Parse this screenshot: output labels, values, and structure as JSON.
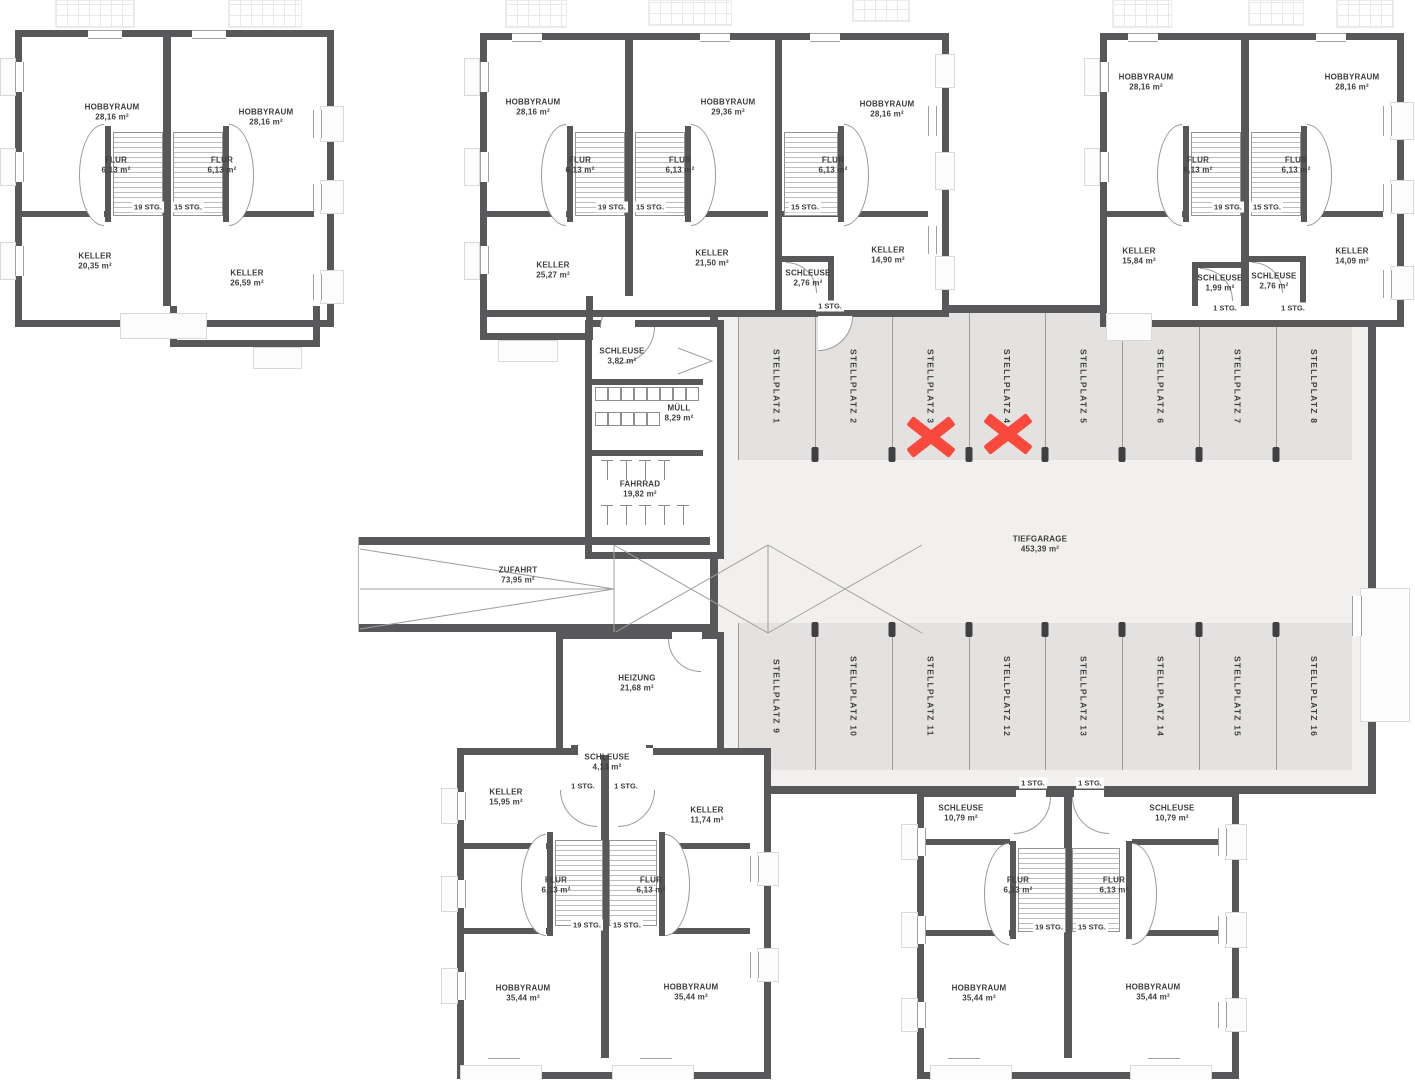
{
  "colors": {
    "wall": "#58585a",
    "stall_bg": "#e3e2e0",
    "aisle_bg": "#f1f0ee",
    "cross": "#f8493c",
    "text": "#3d3d3d",
    "line": "#9c9c9c"
  },
  "stairs": {
    "s19": "19 STG.",
    "s15": "15 STG.",
    "s1": "1 STG."
  },
  "stalls": [
    "STELLPLATZ 1",
    "STELLPLATZ 2",
    "STELLPLATZ 3",
    "STELLPLATZ 4",
    "STELLPLATZ 5",
    "STELLPLATZ 6",
    "STELLPLATZ 7",
    "STELLPLATZ 8",
    "STELLPLATZ 9",
    "STELLPLATZ 10",
    "STELLPLATZ 11",
    "STELLPLATZ 12",
    "STELLPLATZ 13",
    "STELLPLATZ 14",
    "STELLPLATZ 15",
    "STELLPLATZ 16"
  ],
  "markers": {
    "crossed_stalls": [
      "STELLPLATZ 3",
      "STELLPLATZ 4"
    ]
  },
  "rooms": {
    "b1l_hobby": {
      "name": "HOBBYRAUM",
      "area": "28,16 m²"
    },
    "b1l_flur": {
      "name": "FLUR",
      "area": "6,13 m²"
    },
    "b1l_keller": {
      "name": "KELLER",
      "area": "20,35 m²"
    },
    "b1r_hobby": {
      "name": "HOBBYRAUM",
      "area": "28,16 m²"
    },
    "b1r_flur": {
      "name": "FLUR",
      "area": "6,13 m²"
    },
    "b1r_keller": {
      "name": "KELLER",
      "area": "26,59 m²"
    },
    "m1_hobby": {
      "name": "HOBBYRAUM",
      "area": "28,16 m²"
    },
    "m1_flur": {
      "name": "FLUR",
      "area": "6,13 m²"
    },
    "m1_keller": {
      "name": "KELLER",
      "area": "25,27 m²"
    },
    "m2_hobby": {
      "name": "HOBBYRAUM",
      "area": "29,36 m²"
    },
    "m2_flur": {
      "name": "FLUR",
      "area": "6,13 m²"
    },
    "m2_keller": {
      "name": "KELLER",
      "area": "21,50 m²"
    },
    "m3_hobby": {
      "name": "HOBBYRAUM",
      "area": "28,16 m²"
    },
    "m3_flur": {
      "name": "FLUR",
      "area": "6,13 m²"
    },
    "m3_keller": {
      "name": "KELLER",
      "area": "14,90 m²"
    },
    "m3_schleuse": {
      "name": "SCHLEUSE",
      "area": "2,76 m²"
    },
    "b4l_hobby": {
      "name": "HOBBYRAUM",
      "area": "28,16 m²"
    },
    "b4l_flur": {
      "name": "FLUR",
      "area": "6,13 m²"
    },
    "b4l_keller": {
      "name": "KELLER",
      "area": "15,84 m²"
    },
    "b4l_schleuse": {
      "name": "SCHLEUSE",
      "area": "1,99 m²"
    },
    "b4r_hobby": {
      "name": "HOBBYRAUM",
      "area": "28,16 m²"
    },
    "b4r_flur": {
      "name": "FLUR",
      "area": "6,13 m²"
    },
    "b4r_keller": {
      "name": "KELLER",
      "area": "14,09 m²"
    },
    "b4r_schleuse": {
      "name": "SCHLEUSE",
      "area": "2,76 m²"
    },
    "annex_schleuse": {
      "name": "SCHLEUSE",
      "area": "3,82 m²"
    },
    "muell": {
      "name": "MÜLL",
      "area": "8,29 m²"
    },
    "fahrrad": {
      "name": "FAHRRAD",
      "area": "19,82 m²"
    },
    "zufahrt": {
      "name": "ZUFAHRT",
      "area": "73,95 m²"
    },
    "heizung": {
      "name": "HEIZUNG",
      "area": "21,68 m²"
    },
    "tiefgarage": {
      "name": "TIEFGARAGE",
      "area": "453,39 m²"
    },
    "bl_schleuse": {
      "name": "SCHLEUSE",
      "area": "4,13 m²"
    },
    "bll_keller": {
      "name": "KELLER",
      "area": "15,95 m²"
    },
    "blr_keller": {
      "name": "KELLER",
      "area": "11,74 m²"
    },
    "bll_flur": {
      "name": "FLUR",
      "area": "6,13 m²"
    },
    "blr_flur": {
      "name": "FLUR",
      "area": "6,13 m²"
    },
    "bll_hobby": {
      "name": "HOBBYRAUM",
      "area": "35,44 m²"
    },
    "blr_hobby": {
      "name": "HOBBYRAUM",
      "area": "35,44 m²"
    },
    "brl_schleuse": {
      "name": "SCHLEUSE",
      "area": "10,79 m²"
    },
    "brr_schleuse": {
      "name": "SCHLEUSE",
      "area": "10,79 m²"
    },
    "brl_flur": {
      "name": "FLUR",
      "area": "6,13 m²"
    },
    "brr_flur": {
      "name": "FLUR",
      "area": "6,13 m²"
    },
    "brl_hobby": {
      "name": "HOBBYRAUM",
      "area": "35,44 m²"
    },
    "brr_hobby": {
      "name": "HOBBYRAUM",
      "area": "35,44 m²"
    }
  }
}
